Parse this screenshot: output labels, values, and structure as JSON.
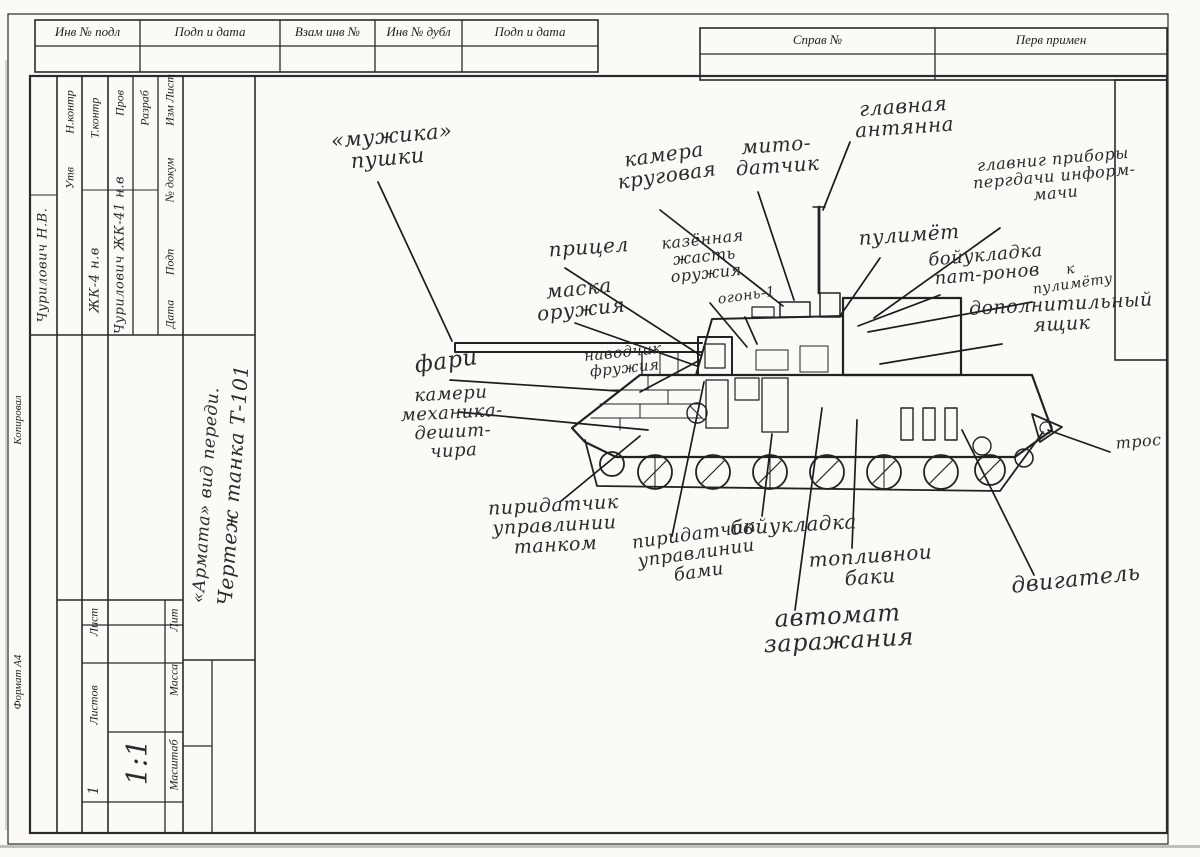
{
  "doc": {
    "top_left_headers": [
      "Инв № подл",
      "Подп и дата",
      "Взам инв №",
      "Инв № дубл",
      "Подп и дата"
    ],
    "top_right_headers": [
      "Справ №",
      "Перв примен"
    ],
    "margin": {
      "copy": "Копировал",
      "format": "Формат  А4"
    }
  },
  "title_block": {
    "header_cells": [
      "Изм  Лист",
      "№ докум",
      "Подп",
      "Дата"
    ],
    "roles": [
      "Разраб",
      "Пров",
      "Т.контр",
      "Н.контр",
      "Утв"
    ],
    "entries": [
      "Чурилович  ЖК-41  н.в",
      "ЖК-4  н.в",
      "Чурилович Н.В."
    ],
    "title_line1": "Чертеж танка Т-101",
    "title_line2": "«Армата» вид переди.",
    "sheet_label": "Лист",
    "sheets_label": "Листов",
    "sheets_value": "1",
    "lit_label": "Лит",
    "mass_label": "Масса",
    "scale_label": "Масштаб",
    "scale_value": "1:1"
  },
  "labels": [
    {
      "id": "gun-muzzle",
      "lines": [
        "«мужика»",
        "пушки"
      ],
      "x": 330,
      "y": 130,
      "rot": -5,
      "size": 21,
      "w": 110
    },
    {
      "id": "sight",
      "lines": [
        "прицел"
      ],
      "x": 543,
      "y": 240,
      "rot": -4,
      "size": 20,
      "w": 90
    },
    {
      "id": "gun-mask",
      "lines": [
        "маска",
        "оружия"
      ],
      "x": 533,
      "y": 283,
      "rot": -6,
      "size": 20,
      "w": 90
    },
    {
      "id": "camera-360",
      "lines": [
        "камера",
        "круговая"
      ],
      "x": 608,
      "y": 152,
      "rot": -8,
      "size": 20,
      "w": 110
    },
    {
      "id": "meteo-sensor",
      "lines": [
        "мито-",
        "датчик"
      ],
      "x": 728,
      "y": 138,
      "rot": -4,
      "size": 20,
      "w": 95
    },
    {
      "id": "main-antenna",
      "lines": [
        "главная",
        "антянна"
      ],
      "x": 845,
      "y": 100,
      "rot": -4,
      "size": 20,
      "w": 115
    },
    {
      "id": "breech",
      "lines": [
        "казённая",
        "жасть",
        "оружия"
      ],
      "x": 652,
      "y": 237,
      "rot": -6,
      "size": 16,
      "w": 100
    },
    {
      "id": "ogon-1",
      "lines": [
        "огонь-1"
      ],
      "x": 716,
      "y": 293,
      "rot": -8,
      "size": 14,
      "w": 60
    },
    {
      "id": "machine-gun",
      "lines": [
        "пулимёт"
      ],
      "x": 858,
      "y": 228,
      "rot": -4,
      "size": 20,
      "w": 95
    },
    {
      "id": "mg-ammo-rack",
      "lines": [
        "бойукладка",
        "пат-ронов"
      ],
      "x": 925,
      "y": 252,
      "rot": -5,
      "size": 18,
      "w": 120
    },
    {
      "id": "for-mg",
      "lines": [
        "к",
        "пулимёту"
      ],
      "x": 1030,
      "y": 268,
      "rot": -8,
      "size": 14,
      "w": 80
    },
    {
      "id": "info-devices",
      "lines": [
        "главниг приборы",
        "пергдачи информ-",
        "мачи"
      ],
      "x": 955,
      "y": 160,
      "rot": -5,
      "size": 16,
      "w": 195
    },
    {
      "id": "extra-box",
      "lines": [
        "дополнитильный",
        "ящик"
      ],
      "x": 968,
      "y": 300,
      "rot": -3,
      "size": 19,
      "w": 185
    },
    {
      "id": "headlights",
      "lines": [
        "фари"
      ],
      "x": 405,
      "y": 355,
      "rot": -8,
      "size": 23,
      "w": 80
    },
    {
      "id": "gunner",
      "lines": [
        "наводчик",
        "фружия"
      ],
      "x": 575,
      "y": 350,
      "rot": -6,
      "size": 15,
      "w": 95
    },
    {
      "id": "driver-cameras",
      "lines": [
        "камери",
        "механика-дешит-",
        "чира"
      ],
      "x": 363,
      "y": 390,
      "rot": -3,
      "size": 18,
      "w": 175
    },
    {
      "id": "tank-control-tx",
      "lines": [
        "пиридатчик",
        "управлинии",
        "танком"
      ],
      "x": 483,
      "y": 500,
      "rot": -3,
      "size": 19,
      "w": 140
    },
    {
      "id": "turret-control-tx",
      "lines": [
        "пиридатчик",
        "управлинии",
        "бами"
      ],
      "x": 628,
      "y": 535,
      "rot": -8,
      "size": 18,
      "w": 130
    },
    {
      "id": "ammo-rack",
      "lines": [
        "бойукладка"
      ],
      "x": 728,
      "y": 518,
      "rot": -3,
      "size": 20,
      "w": 130
    },
    {
      "id": "fuel-tanks",
      "lines": [
        "топливнои",
        "баки"
      ],
      "x": 808,
      "y": 550,
      "rot": -4,
      "size": 20,
      "w": 120
    },
    {
      "id": "autoloader",
      "lines": [
        "автомат",
        "заражания"
      ],
      "x": 752,
      "y": 608,
      "rot": -3,
      "size": 24,
      "w": 170
    },
    {
      "id": "engine",
      "lines": [
        "двигатель"
      ],
      "x": 1010,
      "y": 575,
      "rot": -6,
      "size": 22,
      "w": 130
    },
    {
      "id": "tow-cable",
      "lines": [
        "трос"
      ],
      "x": 1113,
      "y": 436,
      "rot": -5,
      "size": 16,
      "w": 50
    }
  ]
}
